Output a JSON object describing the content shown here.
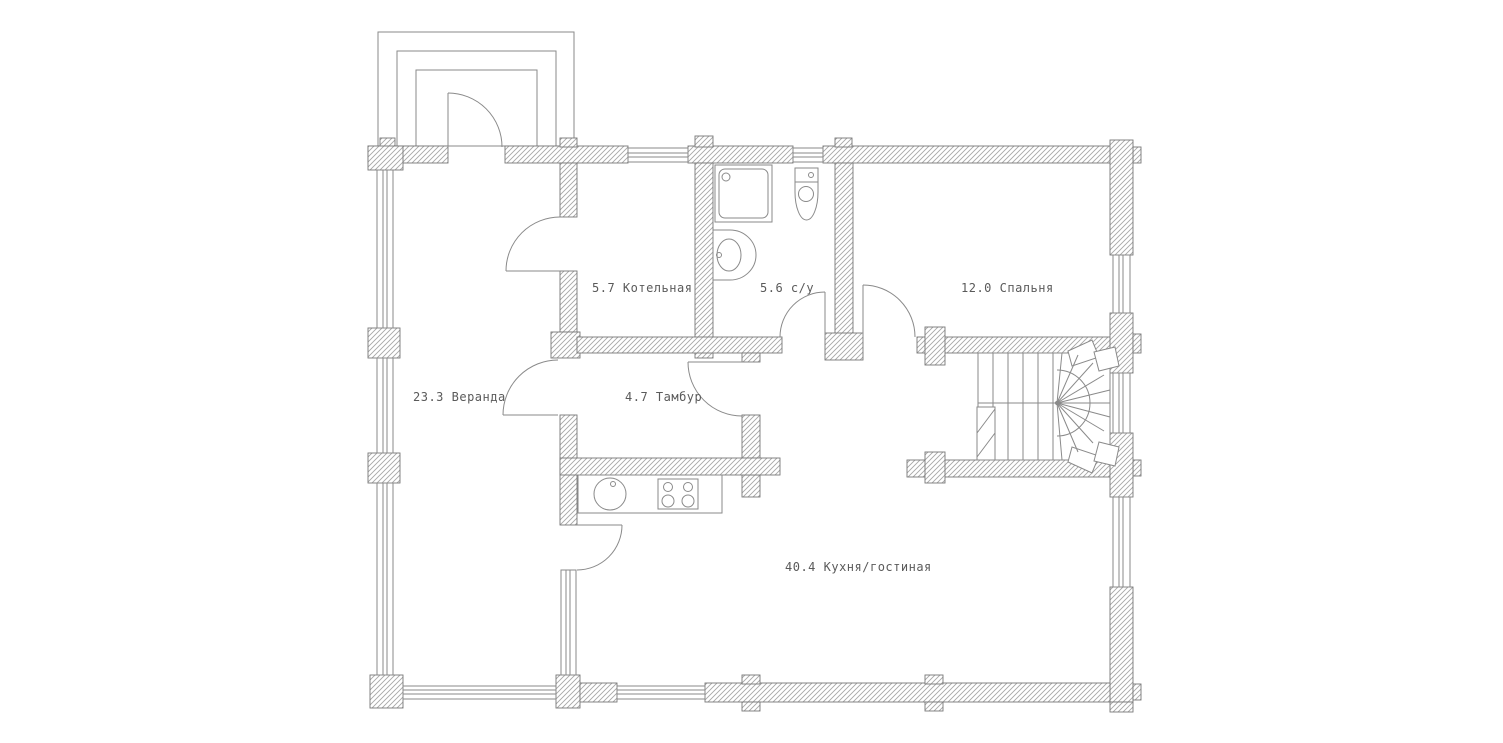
{
  "plan": {
    "rooms": [
      {
        "area": "23.3",
        "name": "Веранда",
        "label": "23.3 Веранда"
      },
      {
        "area": "5.7",
        "name": "Котельная",
        "label": "5.7 Котельная"
      },
      {
        "area": "5.6",
        "name": "с/у",
        "label": "5.6 с/у"
      },
      {
        "area": "12.0",
        "name": "Спальня",
        "label": "12.0 Спальня"
      },
      {
        "area": "4.7",
        "name": "Тамбур",
        "label": "4.7 Тамбур"
      },
      {
        "area": "40.4",
        "name": "Кухня/гостиная",
        "label": "40.4 Кухня/гостиная"
      }
    ],
    "colors": {
      "wall_line": "#777777",
      "hatch_line": "#a6a6a6",
      "text": "#5a5a5a",
      "background": "#ffffff"
    }
  }
}
